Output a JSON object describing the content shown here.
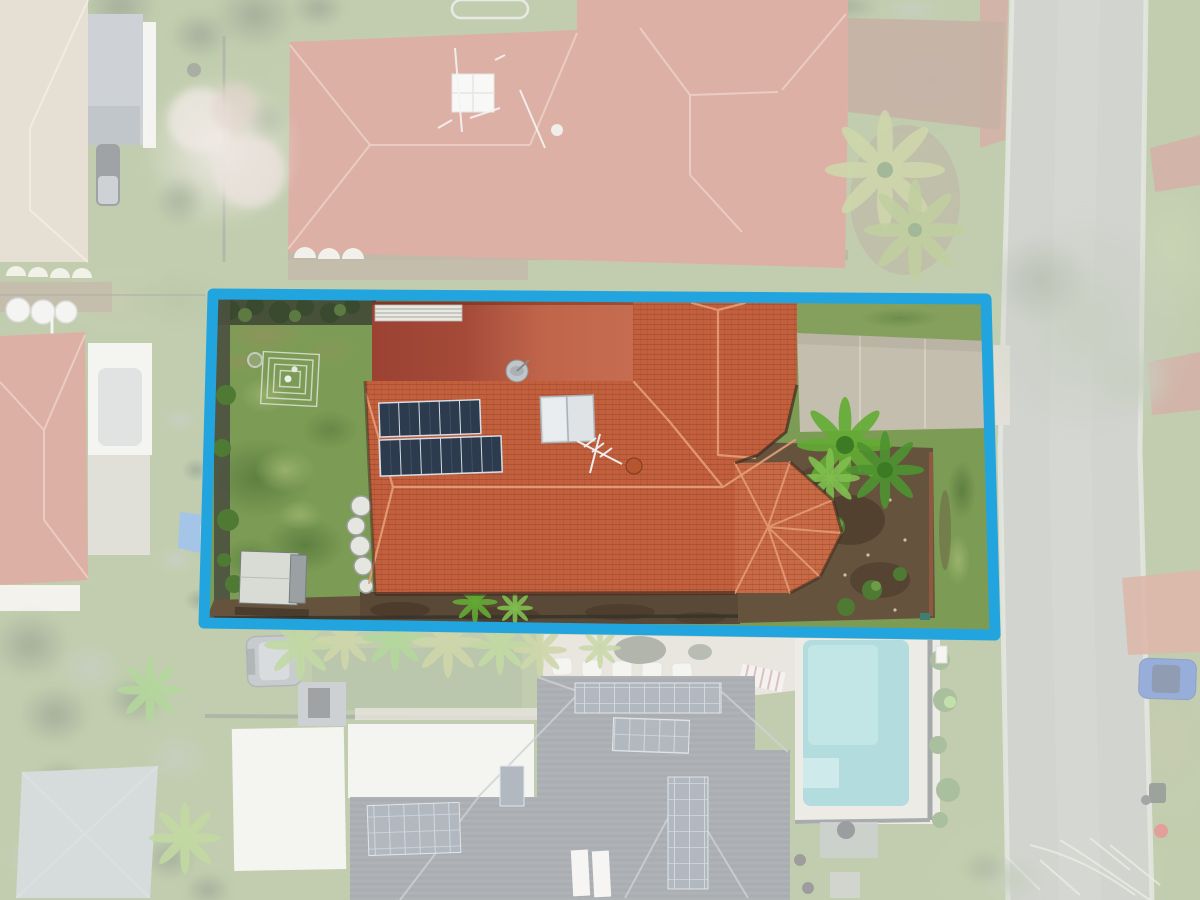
{
  "scene": {
    "kind": "aerial-drone-photo",
    "subject": "suburban-property-lot-highlight"
  },
  "lot": {
    "border_px": 11
  },
  "features": [
    "highlighted-lot-boundary",
    "terracotta-roof-house",
    "flat-patio-roof",
    "solar-panel-array",
    "roof-skylight",
    "satellite-dish",
    "tv-antenna",
    "backyard-lawn",
    "garden-trellis",
    "storage-shed",
    "round-pots",
    "concrete-driveway",
    "tropical-palm-plant",
    "garden-bed",
    "neighbor-house-north",
    "neighbor-house-northwest",
    "neighbor-house-west",
    "neighbor-house-south",
    "swimming-pool",
    "street-road",
    "street-tree",
    "blue-car",
    "grey-suv",
    "shade-sail",
    "blue-tarp",
    "lounge-chairs"
  ],
  "colors": {
    "boundary": "#22a5de",
    "grassBase": "#7e9757",
    "lotGrass": "#7c9c55",
    "patchDark": "#5a7c3e",
    "patchLight": "#9db56f",
    "dryGrass": "#96915f",
    "turf": "#6f8a52",
    "roofMain": "#c2603e",
    "roofBay": "#c76a45",
    "roofRidge": "#e59d77",
    "roofFlatDark": "#9c4233",
    "roofFlatLight": "#c66c50",
    "roofShadow": "#3a2d20",
    "vents": "#e9e9e3",
    "solarDark": "#2c3b4e",
    "solarFrame": "#d7dde3",
    "skylight": "#dfe3e6",
    "dish": "#c0c5c9",
    "hedge": "#47513a",
    "fenceDark": "#4b5140",
    "shrub": "#4f7a33",
    "palmBright": "#63ab33",
    "palmDeep": "#3c7a24",
    "palmYellow": "#9aa84f",
    "dirt": "#66533e",
    "dirtDark": "#4a3a29",
    "mulch": "#5a4936",
    "shed": "#d9dbd5",
    "shedSide": "#9ba1a3",
    "pots": "#e6e6e0",
    "driveway": "#c3bead",
    "drivewayJoint": "#d7d3c5",
    "road": "#a1a59d",
    "roadEdge": "#c7cabe",
    "topRoof": "#b85a44",
    "topRoofRidge": "#d8a08a",
    "deckBrown": "#8a6b52",
    "creamRoof": "#cabda5",
    "creamRidge": "#e2dac6",
    "carport": "#99a0a7",
    "carportDark": "#7e8893",
    "whiteStruct": "#e9e8e2",
    "darkCar": "#3a3f44",
    "bloomCore": "#e2d4cc",
    "treeDark": "#42572f",
    "treeOlive": "#8d9b7e",
    "tank": "#e8e8e4",
    "tarp": "#3f85d6",
    "shadeSail": "#a9b4b6",
    "patio": "#cfcabb",
    "chair": "#e9e8e2",
    "benchStripe": "#b87a88",
    "grayRoof": "#525a62",
    "grayRoofRidge": "#99a1a9",
    "panelArray": "#5e6b7a",
    "panelLine": "#c2cad2",
    "poolDeck": "#d8d5cb",
    "pool": "#5fb6ba",
    "poolLight": "#8ed0d2",
    "poolFrame": "#434b4f",
    "suv": "#8e959b",
    "blueCar": "#2456af",
    "bin": "#2e4030",
    "redObject": "#c4372a",
    "branches": "#d9d6c8",
    "brick": "#a85a48",
    "brickSalmon": "#b96b51",
    "overlay": "#ffffff"
  }
}
